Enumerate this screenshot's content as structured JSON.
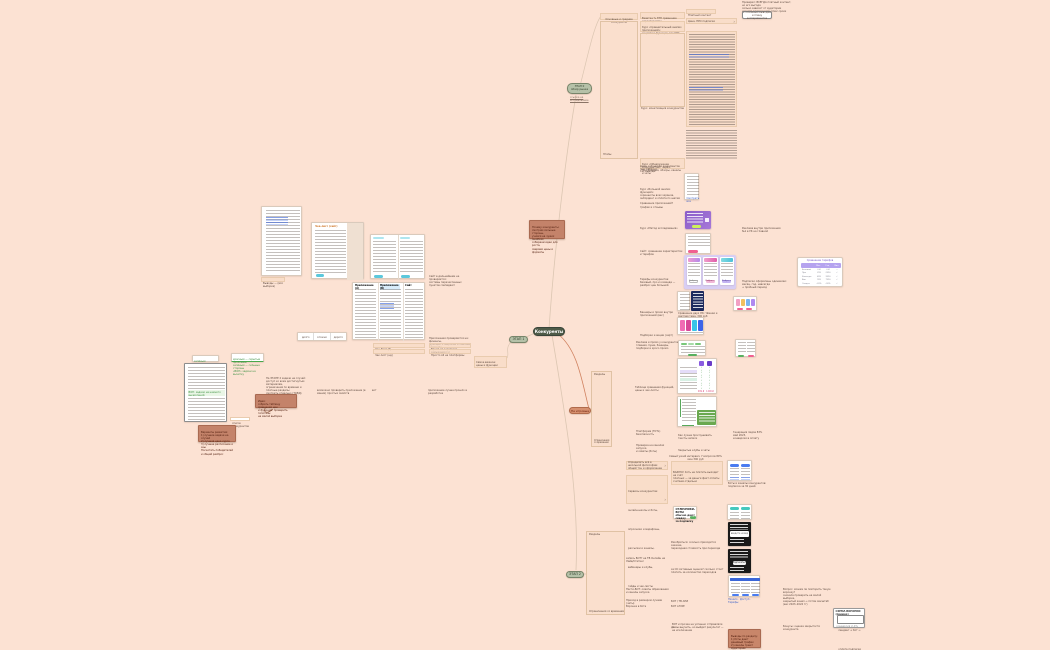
{
  "center": {
    "node": "Конкуренты",
    "stage_top": "ЭТАП 0\nобзор рынка",
    "stage_top_link": "ссылка на исследование",
    "stage_left": "ЭТАП 1",
    "stage_side": "Не игровые",
    "stage_bottom": "ЭТАП 2",
    "brown_note": "Почему конкуренты:\nсмотрим сильные стороны,\nучимся на чужих ошибках,\nсобираем идеи для роста,\nсверяем цены и форматы"
  },
  "left": {
    "doc1_caption": "Выводы — (вся выборка)",
    "doc2_title": "Чек-лист (сайт)",
    "strip_c1": "долго",
    "strip_c2": "сложно",
    "strip_c3": "дорого",
    "note_site": "Сайт в дальнейшем не проверяется:\nсистемы перечисленных пунктов совпадают",
    "note_apps": "Приложения проверяются на: финансы,\nфункции + широкие и обычные элементы",
    "row_checklist_b": "Чек Лист (б)",
    "row_checklist_b_r": "Время от короткого замыкания (ч)",
    "row_checklist_nd": "Чек лист (нд)",
    "row_checklist_nd_r": "Просто All на платформы",
    "green_a": "зелёным выделено то,\nчто можно переиспользовать",
    "green_b": "красным — скрытые проблемы,\nзелёным — сильные стороны\n«ВОП» задачи на вычитку",
    "doc_caption": "список конкурентов",
    "doc_green_line": "ВОП: задачи на немного вычислений",
    "brown_1": "Варианты развития:\n1) лучшие задачи на случай\n2) лучшая цена курса\n3) лучшее расписание и азы\nПосчитать победителей и общий разброс",
    "text_stage2": "На ЭТАПЕ 2 задачи на случай:\nдоступ ко всем достигнутым материалам,\nограничения по времени и платные разделы\nсмотреть отдельно (ТОВД)",
    "brown_2": "Идея:\nсобрать таблицу сравнения цен\nи функций, проверить гипотезы\nна малой выборке",
    "micro_1": "возможно проверить приложение (в мании) простых свойств",
    "micro_2": "вот",
    "micro_3": "приложение лучше прошло в разработке",
    "box_sa": "Самое важное:\nцены и функции",
    "tbl_h1": "Приложение (А)",
    "tbl_h2": "Приложение (Б)",
    "tbl_h3": "Сайт"
  },
  "topright": {
    "parent": "Основные и средние конкуренты",
    "bracket": "Этапы",
    "cell1": "Визитка % ЭТП сравнение характеристик",
    "cell2": "Курс «Сравнительный анализ приложений»:\nсоцсети и функции, вес 90%",
    "cell3_label": "Курс: монетизация конкурентов",
    "cell4": "Курс «Обнаружение конкурентов»: через\nприложения, обзоры, каналы и чаты",
    "paid": "Платный контент",
    "price_row": "Цена, ПРО подписки",
    "chevron": "›",
    "note": "Проверил: ВСЕГДА платный контент, но его выгода\nсильно зависит от аудитории\nи места размещения, плюс сроки",
    "button": "к основным выводам\nи плану экспериментов"
  },
  "mid": {
    "bracket": "Разделы",
    "bracket_limit": "Ограничения со временем",
    "row_a1": "Цены и функции конкурентов (вес таблиц)",
    "row_a2": "См. выводы",
    "block_b": "Курс «Большой анализ функций»:\nскриншоты всех экранов,\nонбординг и оплата по шагам",
    "row_c1": "Сравнение приложений?",
    "row_c2": "трафик и отзывы",
    "shot1_link": "Смотреть все",
    "row_e": "Курс «Метод исследования»",
    "note_g": "Реклама внутри приложения №1 в УК на главной",
    "row_i": "Сайт: сравнение характеристик\nи тарифов",
    "text_k": "Тарифы конкурентов:\nбазовый, про и команда —\nразброс цен большой",
    "note_l": "Подписки оформлены одинаково:\nмесяц, год, навсегда\n+ пробный период",
    "btn_choose": "Выбрать",
    "price_title": "Сравнение тарифов",
    "price_h1": "Мес",
    "price_h2": "Год",
    "price_h3": "Вип",
    "price_labels": "Базовый\nПро\nКоманда\nВип\nСкидка",
    "price_c1": "0 ₽\n299\n499\n999\n-20%",
    "price_c2": "0 ₽\n2390\n3990\n7990\n-30%",
    "price_c3": "—\n✓\n✓\n✓\n✓",
    "caption_phones": "Сравнение двух ЛК: тёмная и светлая тема, 300 руб",
    "row_p": "Баннеры и промо внутри приложений (вес)",
    "row_r": "Подборки и акции (чарт)",
    "text_s": "Реклама и промо у конкурентов:\nглавная, пуши, баннеры,\nподборки и кросс-промо",
    "checks": "✓\n✓\n✓\n✓\n✓\n✓\n✓\n✓\n✓",
    "cmp_price1": "999 ₽",
    "cmp_price2": "1290 ₽",
    "caption_w": "Таблица сравнения функций,\nцены и чек-листы",
    "row_y1": "Платформа (TOTL) безопасность",
    "row_y2": "Как лучше прослушивать тексты записи",
    "note_n1": "Генерация лидов 83%\nмай 2023,\nконверсия в оплату",
    "row_y3": "Проверка на каналах запуска\nи охваты (боты)",
    "row_y4": "Закрытые клубы и чаты",
    "caption_c": "Самый узкий интервал, 7 вопросов 80% мин 300 руб"
  },
  "bottom": {
    "cell_aa": "Определить всё в школьной философии:\nобщий тон и оформление",
    "cell_bb": "Сервисы конкурентов:\nонлайн-школы и боты,\nопросники и марафоны,\nрассылки и каналы,\nвебинары и клубы,\nгайды и чек-листы",
    "bracket": "Разделы",
    "bracket_limit": "Ограничения со временем",
    "chevron": "›",
    "row_d1": "запись БОТ? на ТВ Онлайн на Лайв/Статикс",
    "row_d2": "Насти-БОТ: охваты образования\nи каналы запуска",
    "row_d3": "Приход в размером лучами (чаты)",
    "row_d4": "Воронка в боте",
    "text_ee": "ВАЖНО! Хоть не платить выходит на счёт\nплатных — за деньги факт оплаты\nсчитаем отдельно",
    "card_ff": "ОТЛИЧНИКИ-БОТЫ\nобычно дают скидку\nза подписку",
    "chip_ok": "ОК",
    "note_gg": "Разобраться: сколько приходится закачек,\nпереходная стоимость при переходе",
    "note_hh": "за ОС Активные оценки? сколько стоит\nплатить за количество переходов",
    "row_ii1": "БОТ / ТВ АНИ",
    "row_ii2": "БОТ АН БЕ",
    "row_jj": "да",
    "caption_ll": "Боты и каналы конкурентов: подписка за 30 дней",
    "dark_input": "введите номер",
    "dark_btn": "Подписаться",
    "links_pp": "Начало · Доступ · Тарифы",
    "note_qq": "Вопрос: можем ли повторить такую воронку?\nсначала проверить на малой выборке,\nзакрытый канал → потом масштаб\n(вес 2023–2024 гг)",
    "card_rr_title": "СХЕМА ВОРОНКИ (пример)",
    "card_rr_box": "лендинг → бот →\nоплата подписки\nв два шага",
    "card_rr_foot": "конверсия 2–4%",
    "caption_ss": "ВОТ и прочие не успешно отправляли темы выучить, но выйдет результат — не исключение",
    "note_tt": "Бонусы: оценка закрытости конкурента",
    "brown": "Выводы по разделу:\n1) боты дают дешёвый трафик\n2) каналы греют аудиторию\n3) оплата внутри бота\nработает лучше сайта —\nпроверяем на своём"
  }
}
